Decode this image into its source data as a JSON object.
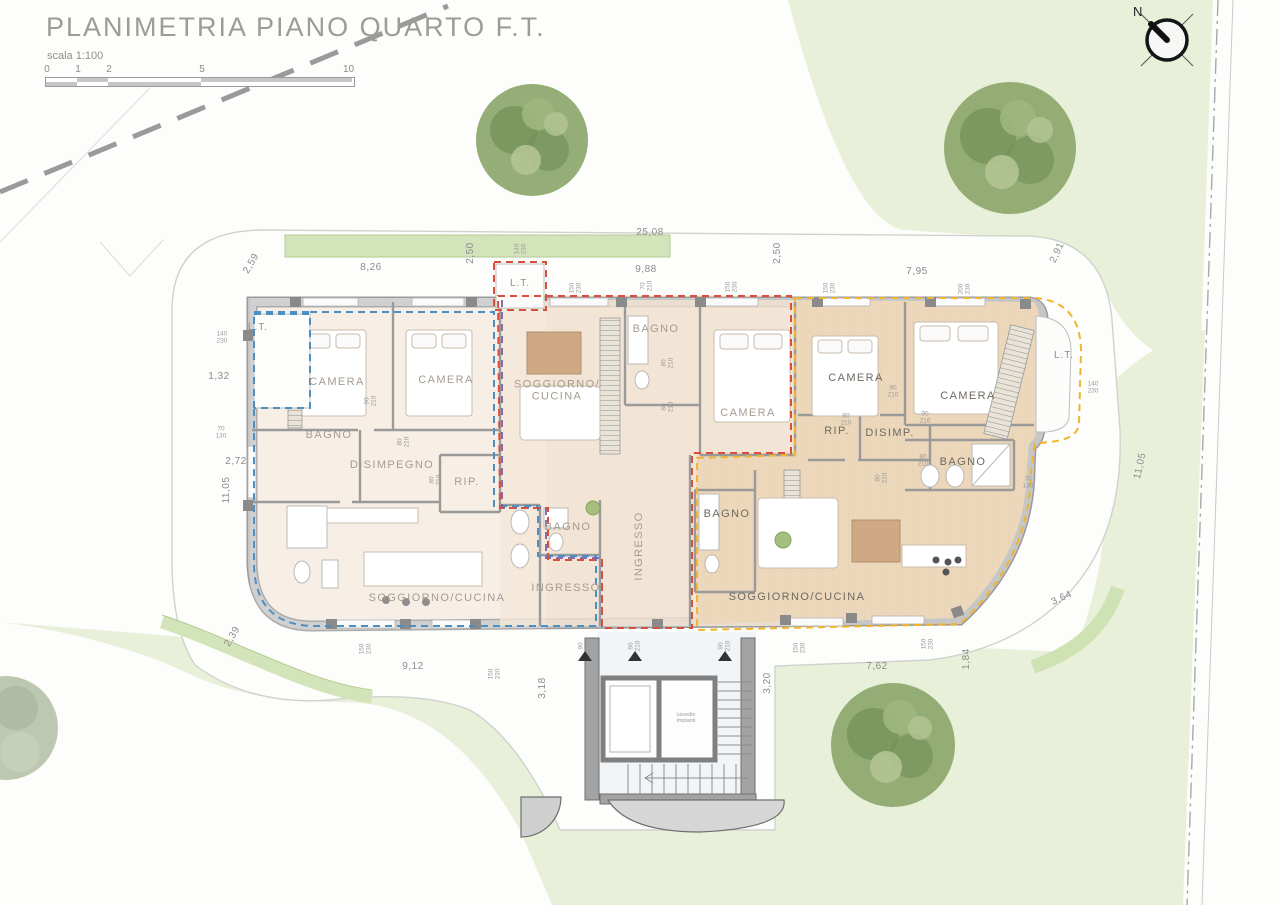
{
  "title": "PLANIMETRIA PIANO QUARTO F.T.",
  "scale": {
    "label": "scala 1:100",
    "ticks": [
      "0",
      "1",
      "2",
      "5",
      "10 m"
    ]
  },
  "north": {
    "label": "N"
  },
  "colors": {
    "paper": "#fdfdfb",
    "lawn": "#e9f0da",
    "hedge": "#d3e4ba",
    "wall": "#c6c6c6",
    "wall_edge": "#9a9a9a",
    "floor_left": "#f6ece0",
    "floor_mid": "#f2e4d2",
    "floor_right": "#ecd7ba",
    "unit_blue": "#4a90c4",
    "unit_red": "#d94f3d",
    "unit_purple": "#7b5ea7",
    "unit_yellow": "#f0b42e",
    "tree_dark": "#74925a",
    "tree_mid": "#8fa96f",
    "tree_light": "#b3c493"
  },
  "room_labels": [
    {
      "text": "CAMERA",
      "x": 337,
      "y": 383
    },
    {
      "text": "CAMERA",
      "x": 446,
      "y": 381
    },
    {
      "text": "BAGNO",
      "x": 329,
      "y": 436
    },
    {
      "text": "DISIMPEGNO",
      "x": 392,
      "y": 466
    },
    {
      "text": "RIP.",
      "x": 467,
      "y": 483
    },
    {
      "text": "SOGGIORNO/CUCINA",
      "x": 437,
      "y": 599
    },
    {
      "text": "BAGNO",
      "x": 568,
      "y": 528
    },
    {
      "text": "INGRESSO",
      "x": 566,
      "y": 589
    },
    {
      "text": "SOGGIORNO/\nCUCINA",
      "x": 557,
      "y": 391
    },
    {
      "text": "BAGNO",
      "x": 656,
      "y": 330
    },
    {
      "text": "CAMERA",
      "x": 748,
      "y": 414
    },
    {
      "text": "INGRESSO",
      "x": 640,
      "y": 546,
      "rot": -90
    },
    {
      "text": "CAMERA",
      "x": 856,
      "y": 379,
      "dark": true
    },
    {
      "text": "CAMERA",
      "x": 968,
      "y": 397,
      "dark": true
    },
    {
      "text": "RIP.",
      "x": 837,
      "y": 432,
      "dark": true
    },
    {
      "text": "DISIMP.",
      "x": 890,
      "y": 434,
      "dark": true
    },
    {
      "text": "BAGNO",
      "x": 963,
      "y": 463,
      "dark": true
    },
    {
      "text": "BAGNO",
      "x": 727,
      "y": 515,
      "dark": true
    },
    {
      "text": "SOGGIORNO/CUCINA",
      "x": 797,
      "y": 598,
      "dark": true
    }
  ],
  "dim_labels": [
    {
      "text": "25,08",
      "x": 650,
      "y": 233
    },
    {
      "text": "2,59",
      "x": 252,
      "y": 264,
      "rot": -60
    },
    {
      "text": "8,26",
      "x": 371,
      "y": 268
    },
    {
      "text": "2,50",
      "x": 471,
      "y": 253,
      "rot": -90
    },
    {
      "text": "9,88",
      "x": 646,
      "y": 270
    },
    {
      "text": "2,50",
      "x": 778,
      "y": 253,
      "rot": -90
    },
    {
      "text": "7,95",
      "x": 917,
      "y": 272
    },
    {
      "text": "2,91",
      "x": 1058,
      "y": 253,
      "rot": -65
    },
    {
      "text": "1,32",
      "x": 219,
      "y": 377
    },
    {
      "text": "2,72",
      "x": 236,
      "y": 462
    },
    {
      "text": "11,05",
      "x": 227,
      "y": 490,
      "rot": -90
    },
    {
      "text": "2,39",
      "x": 233,
      "y": 637,
      "rot": -60
    },
    {
      "text": "9,12",
      "x": 413,
      "y": 667
    },
    {
      "text": "3,18",
      "x": 543,
      "y": 688,
      "rot": -90
    },
    {
      "text": "3,20",
      "x": 768,
      "y": 683,
      "rot": -90
    },
    {
      "text": "7,62",
      "x": 877,
      "y": 667
    },
    {
      "text": "1,84",
      "x": 967,
      "y": 659,
      "rot": -90
    },
    {
      "text": "3,64",
      "x": 1062,
      "y": 599,
      "rot": -25
    },
    {
      "text": "11,05",
      "x": 1141,
      "y": 466,
      "rot": -78
    }
  ],
  "open_labels": [
    {
      "text": "140\n230",
      "x": 521,
      "y": 249,
      "rot": -90
    },
    {
      "text": "150\n230",
      "x": 576,
      "y": 288,
      "rot": -90
    },
    {
      "text": "70\n210",
      "x": 647,
      "y": 286,
      "rot": -90
    },
    {
      "text": "150\n230",
      "x": 732,
      "y": 287,
      "rot": -90
    },
    {
      "text": "150\n230",
      "x": 830,
      "y": 288,
      "rot": -90
    },
    {
      "text": "200\n230",
      "x": 965,
      "y": 289,
      "rot": -90
    },
    {
      "text": "140\n230",
      "x": 222,
      "y": 338
    },
    {
      "text": "70\n130",
      "x": 221,
      "y": 433
    },
    {
      "text": "140\n230",
      "x": 1093,
      "y": 388
    },
    {
      "text": "70\n130",
      "x": 1028,
      "y": 483
    },
    {
      "text": "150\n230",
      "x": 366,
      "y": 649,
      "rot": -90
    },
    {
      "text": "150\n230",
      "x": 495,
      "y": 674,
      "rot": -90
    },
    {
      "text": "90\n210",
      "x": 585,
      "y": 646,
      "rot": -90
    },
    {
      "text": "90\n210",
      "x": 635,
      "y": 646,
      "rot": -90
    },
    {
      "text": "90\n210",
      "x": 725,
      "y": 646,
      "rot": -90
    },
    {
      "text": "150\n230",
      "x": 800,
      "y": 648,
      "rot": -90
    },
    {
      "text": "150\n230",
      "x": 928,
      "y": 644,
      "rot": -90
    },
    {
      "text": "90\n210",
      "x": 371,
      "y": 401,
      "rot": -90
    },
    {
      "text": "80\n210",
      "x": 404,
      "y": 442,
      "rot": -90
    },
    {
      "text": "80\n210",
      "x": 436,
      "y": 480,
      "rot": -90
    },
    {
      "text": "80\n210",
      "x": 668,
      "y": 363,
      "rot": -90
    },
    {
      "text": "80\n210",
      "x": 668,
      "y": 407,
      "rot": -90
    },
    {
      "text": "80\n210",
      "x": 893,
      "y": 392
    },
    {
      "text": "90\n210",
      "x": 925,
      "y": 418
    },
    {
      "text": "80\n210",
      "x": 846,
      "y": 420
    },
    {
      "text": "80\n210",
      "x": 923,
      "y": 461
    },
    {
      "text": "80\n210",
      "x": 882,
      "y": 478,
      "rot": -90
    }
  ],
  "misc_labels": [
    {
      "text": "L.T.",
      "x": 258,
      "y": 328,
      "cls": "lt"
    },
    {
      "text": "L.T.",
      "x": 520,
      "y": 284,
      "cls": "lt"
    },
    {
      "text": "L.T.",
      "x": 1064,
      "y": 356,
      "cls": "lt"
    },
    {
      "text": "cavedio\nimpianti",
      "x": 686,
      "y": 719,
      "cls": "tiny"
    }
  ]
}
